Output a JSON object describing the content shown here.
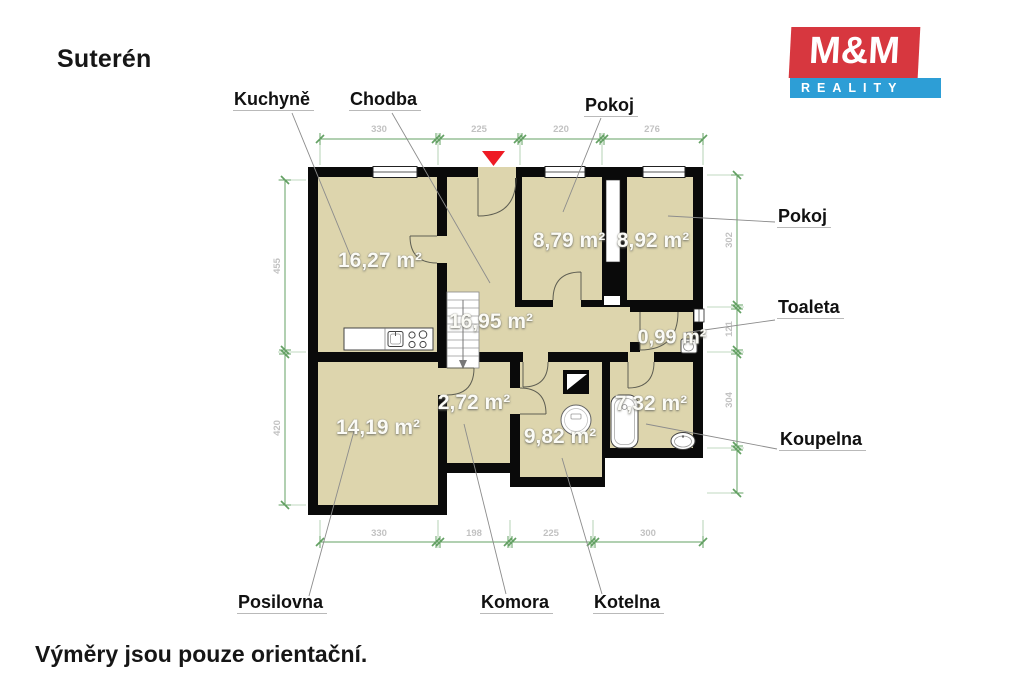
{
  "page": {
    "title": "Suterén",
    "footnote": "Výměry jsou pouze orientační."
  },
  "logo": {
    "top": "M&M",
    "bottom": "REALITY"
  },
  "colors": {
    "room_fill": "#ddd5ad",
    "wall": "#0a0a0a",
    "dimension_green": "#63a063",
    "leader_gray": "#8c8c8c",
    "entrance_marker_red": "#ee1b24",
    "logo_red": "#d7373f",
    "logo_blue": "#2d9ed6"
  },
  "rooms": [
    {
      "label": "Kuchyně",
      "area": "16,27 m²"
    },
    {
      "label": "Chodba",
      "area": "16,95 m²"
    },
    {
      "label": "Pokoj",
      "area": "8,79 m²"
    },
    {
      "label": "Pokoj",
      "area": "8,92 m²"
    },
    {
      "label": "Toaleta",
      "area": "0,99 m²"
    },
    {
      "label": "Koupelna",
      "area": "7,32 m²"
    },
    {
      "label": "Posilovna",
      "area": "14,19 m²"
    },
    {
      "label": "Komora",
      "area": "2,72 m²"
    },
    {
      "label": "Kotelna",
      "area": "9,82 m²"
    }
  ],
  "dimensions": {
    "top": [
      "330",
      "225",
      "220",
      "276"
    ],
    "bottom": [
      "330",
      "198",
      "225",
      "300"
    ],
    "left": [
      "455",
      "420"
    ],
    "right": [
      "302",
      "121",
      "304"
    ]
  }
}
